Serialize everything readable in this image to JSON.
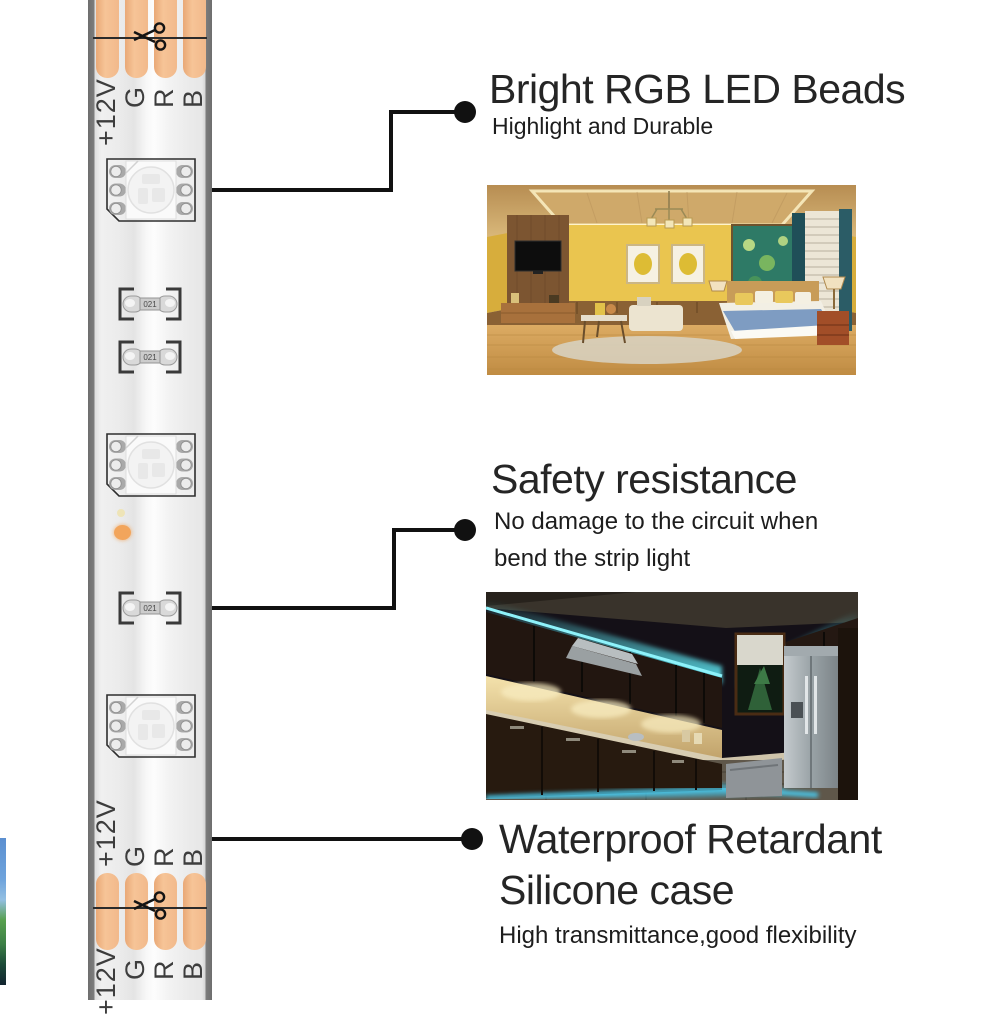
{
  "strip": {
    "pin_labels": [
      "+12V",
      "G",
      "R",
      "B"
    ],
    "resistor_marking": "021",
    "colors": {
      "copper_pad": "#f3bb8e",
      "strip_edge": "#6e6e6e",
      "strip_body": "#f0f0f0",
      "marker_dot": "#f2a55c",
      "cut_line": "#2b2b2b"
    },
    "icons": {
      "scissors": "scissors-icon",
      "led_chip": "rgb-5050-led-chip",
      "resistor": "smd-resistor"
    }
  },
  "callouts": [
    {
      "title": "Bright RGB LED Beads",
      "subtitle": "Highlight and Durable"
    },
    {
      "title": "Safety resistance",
      "subtitle_line1": "No damage to the circuit when",
      "subtitle_line2": "bend the strip light"
    },
    {
      "title_line1": "Waterproof Retardant",
      "title_line2": "Silicone case",
      "subtitle": "High transmittance,good flexibility"
    }
  ],
  "photos": {
    "bedroom": "bedroom-with-led-cove-lighting",
    "kitchen": "kitchen-with-rgb-led-lighting",
    "accent_cyan": "#5ce4f0",
    "accent_warm": "#e8c64f"
  }
}
